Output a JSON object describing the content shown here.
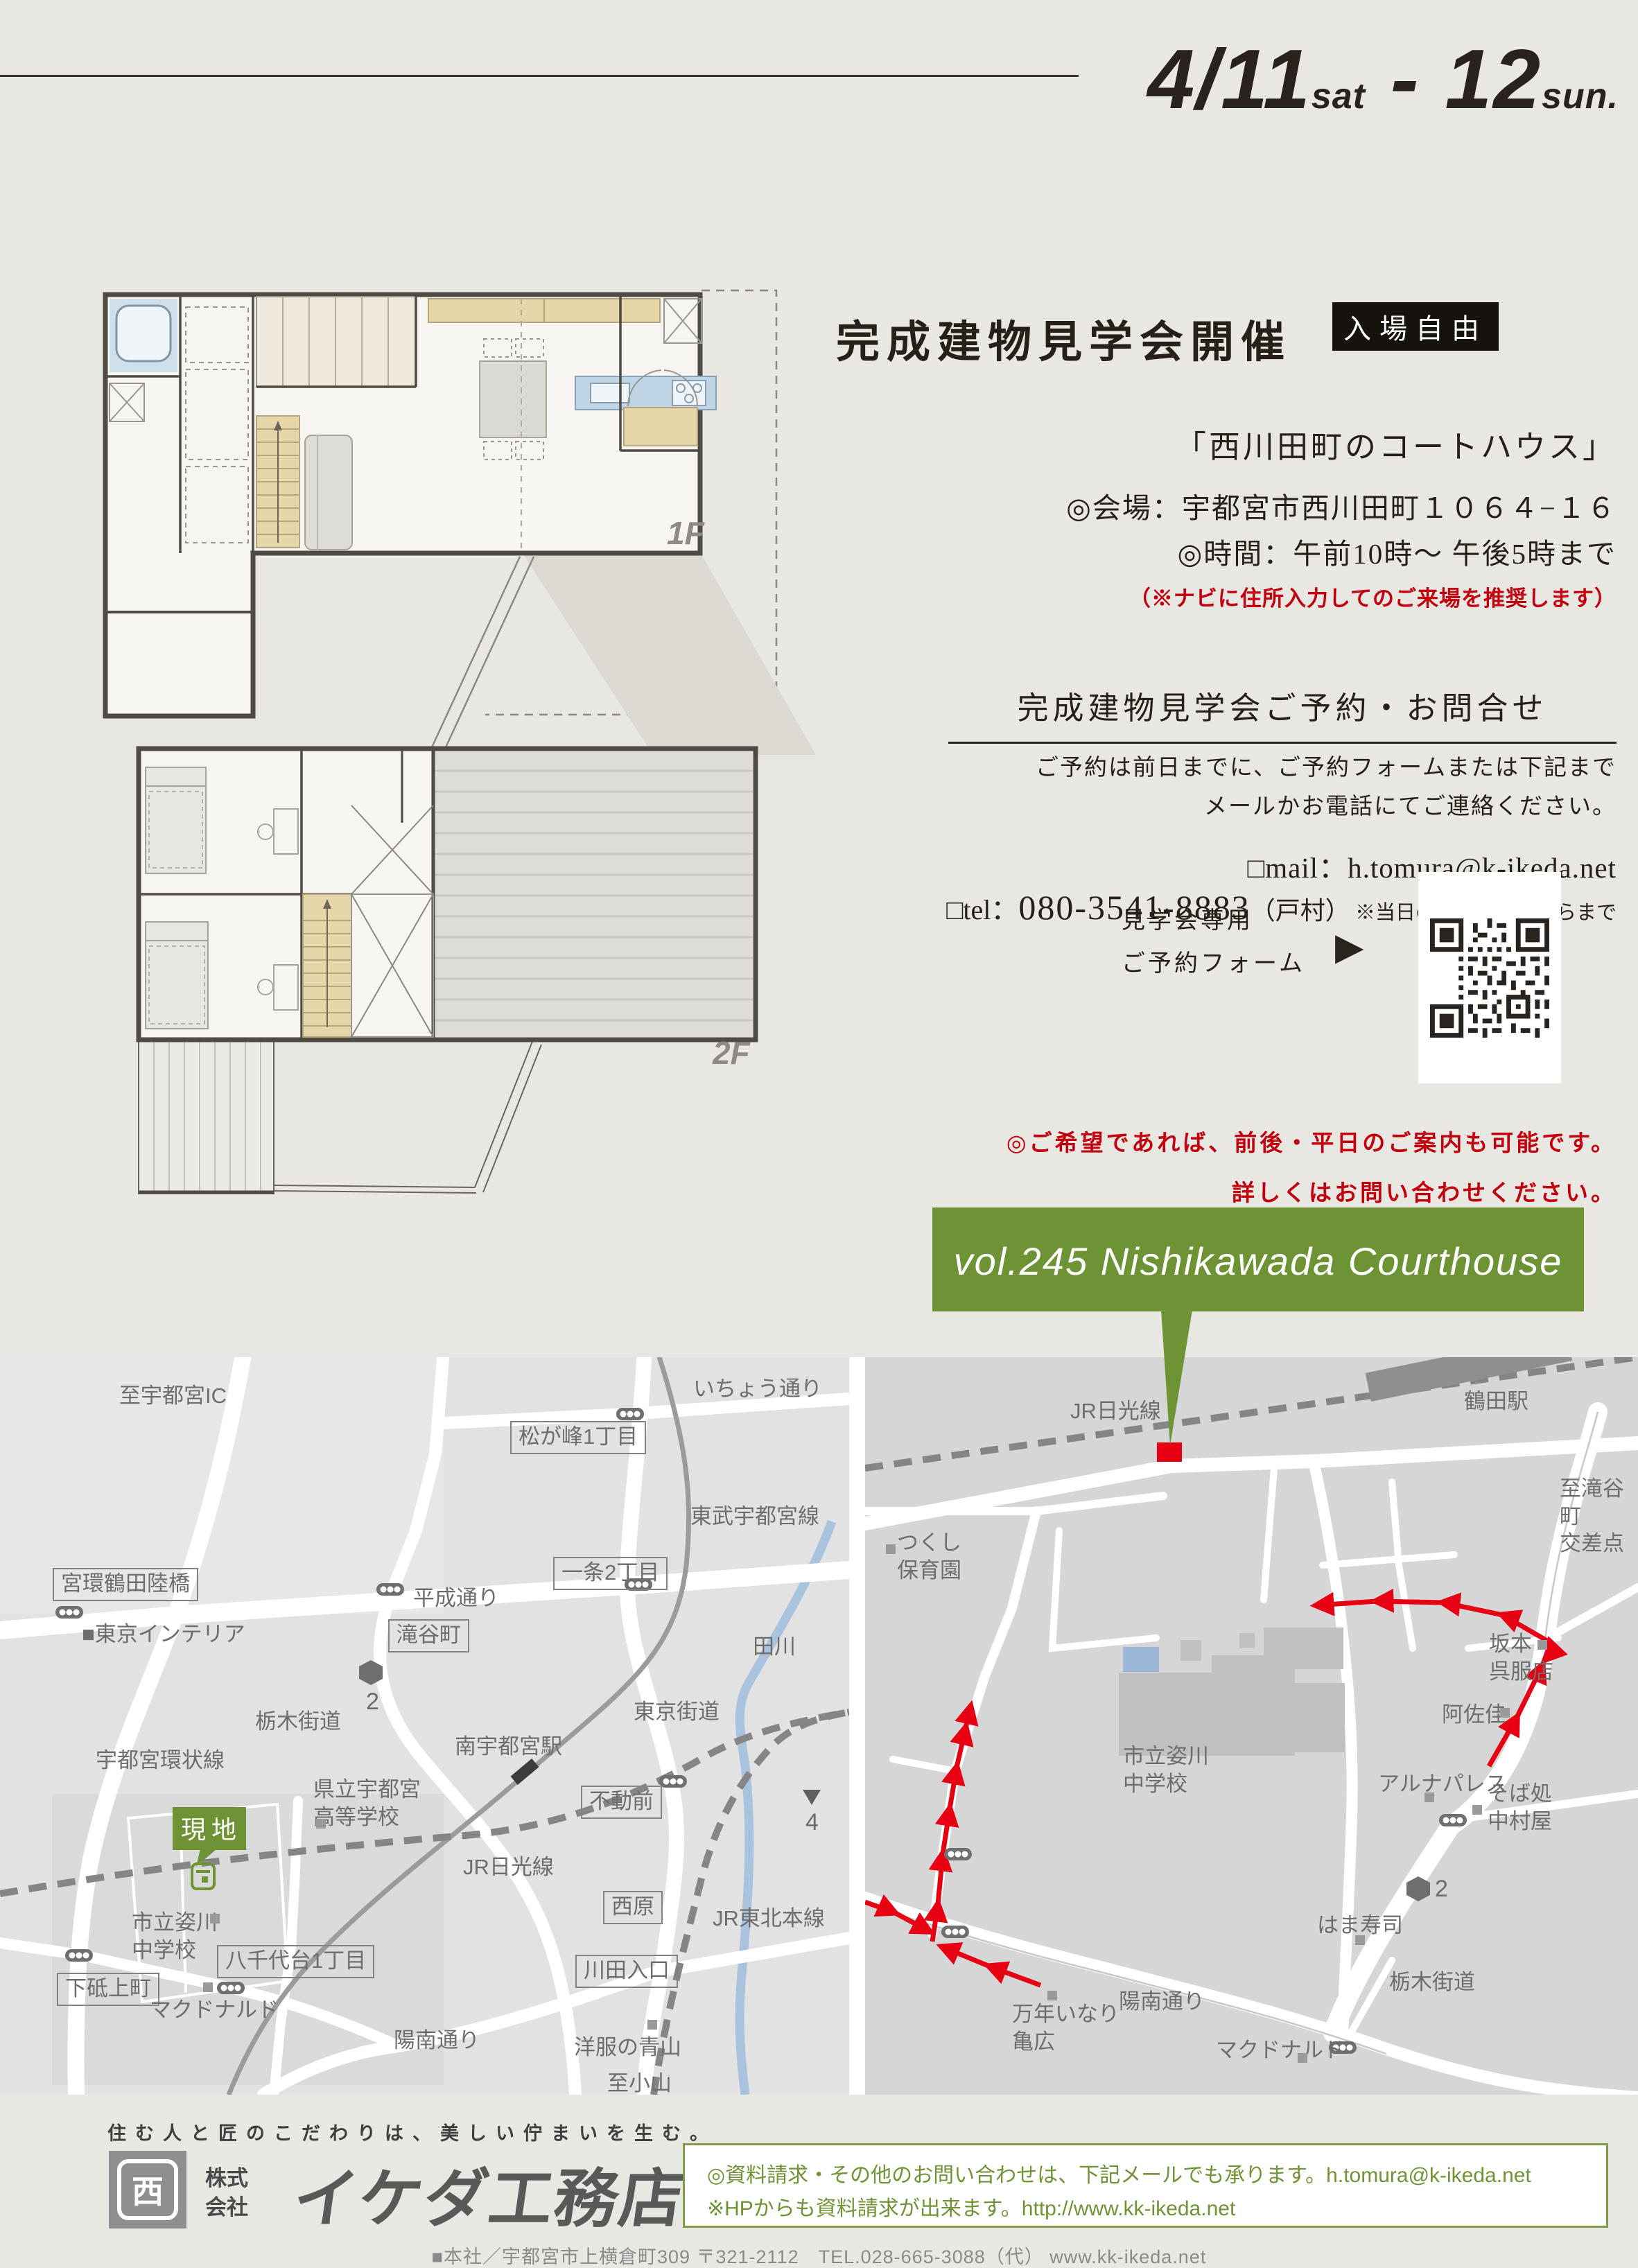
{
  "header": {
    "date_day1": "4/11",
    "date_sat": "sat",
    "date_dash": " - ",
    "date_day2": "12",
    "date_sun": "sun."
  },
  "plans": {
    "floor1_label": "1F",
    "floor2_label": "2F"
  },
  "event": {
    "title": "完成建物見学会開催",
    "badge": "入場自由",
    "subtitle": "「西川田町のコートハウス」",
    "venue": "◎会場：宇都宮市西川田町１０６４−１６",
    "time": "◎時間：午前10時〜 午後5時まで",
    "nav_note": "（※ナビに住所入力してのご来場を推奨します）",
    "reserve_heading": "完成建物見学会ご予約・お問合せ",
    "reserve_line1": "ご予約は前日までに、ご予約フォームまたは下記まで",
    "reserve_line2": "メールかお電話にてご連絡ください。",
    "mail": "□mail：h.tomura@k-ikeda.net",
    "tel_prefix": "□tel：",
    "tel_number": "080-3541-8883",
    "tel_person": "（戸村）",
    "tel_note": " ※当日の道案内もこちらまで",
    "qr_caption1": "見学会専用",
    "qr_caption2": "ご予約フォーム",
    "qr_arrow": "▶",
    "weekday_note1": "◎ご希望であれば、前後・平日のご案内も可能です。",
    "weekday_note2": "詳しくはお問い合わせください。"
  },
  "banner": {
    "text": "vol.245  Nishikawada Courthouse",
    "color": "#6d9334"
  },
  "maps": {
    "site_label": "現地",
    "colors": {
      "route_red": "#e60012",
      "rail_gray": "#858585",
      "river_blue": "#a9c3de",
      "accent_green": "#6d9334"
    },
    "left": {
      "labels": [
        {
          "text": "至宇都宮IC"
        },
        {
          "text": "いちょう通り"
        },
        {
          "text": "松が峰1丁目"
        },
        {
          "text": "東武宇都宮線"
        },
        {
          "text": "一条2丁目"
        },
        {
          "text": "平成通り"
        },
        {
          "text": "宮環鶴田陸橋"
        },
        {
          "text": "滝谷町"
        },
        {
          "text": "■東京インテリア"
        },
        {
          "text": "田川"
        },
        {
          "text": "東京街道"
        },
        {
          "text": "南宇都宮駅"
        },
        {
          "text": "栃木街道"
        },
        {
          "text": "不動前"
        },
        {
          "text": "宇都宮環状線"
        },
        {
          "text": "県立宇都宮\n高等学校"
        },
        {
          "text": "JR日光線"
        },
        {
          "text": "市立姿川\n中学校"
        },
        {
          "text": "西原"
        },
        {
          "text": "川田入口"
        },
        {
          "text": "JR東北本線"
        },
        {
          "text": "八千代台1丁目"
        },
        {
          "text": "下砥上町"
        },
        {
          "text": "マクドナルド"
        },
        {
          "text": "洋服の青山"
        },
        {
          "text": "陽南通り"
        },
        {
          "text": "至小山"
        },
        {
          "text": "2"
        },
        {
          "text": "4"
        }
      ]
    },
    "right": {
      "labels": [
        {
          "text": "JR日光線"
        },
        {
          "text": "鶴田駅"
        },
        {
          "text": "至滝谷町\n交差点"
        },
        {
          "text": "つくし\n保育園"
        },
        {
          "text": "坂本\n呉服店"
        },
        {
          "text": "阿佐佳"
        },
        {
          "text": "アルナパレス"
        },
        {
          "text": "そば処\n中村屋"
        },
        {
          "text": "市立姿川\n中学校"
        },
        {
          "text": "はま寿司"
        },
        {
          "text": "栃木街道"
        },
        {
          "text": "万年いなり\n亀広"
        },
        {
          "text": "陽南通り"
        },
        {
          "text": "マクドナルド"
        },
        {
          "text": "2"
        }
      ]
    }
  },
  "footer": {
    "tagline": "住む人と匠のこだわりは、美しい佇まいを生む。",
    "logo_mark": "西",
    "company_prefix1": "株式",
    "company_prefix2": "会社",
    "company_name": "イケダ工務店",
    "info_line1": "◎資料請求・その他のお問い合わせは、下記メールでも承ります。h.tomura@k-ikeda.net",
    "info_line2": "※HPからも資料請求が出来ます。http://www.kk-ikeda.net",
    "address_line": "■本社／宇都宮市上横倉町309 〒321-2112　TEL.028-665-3088（代） www.kk-ikeda.net"
  }
}
